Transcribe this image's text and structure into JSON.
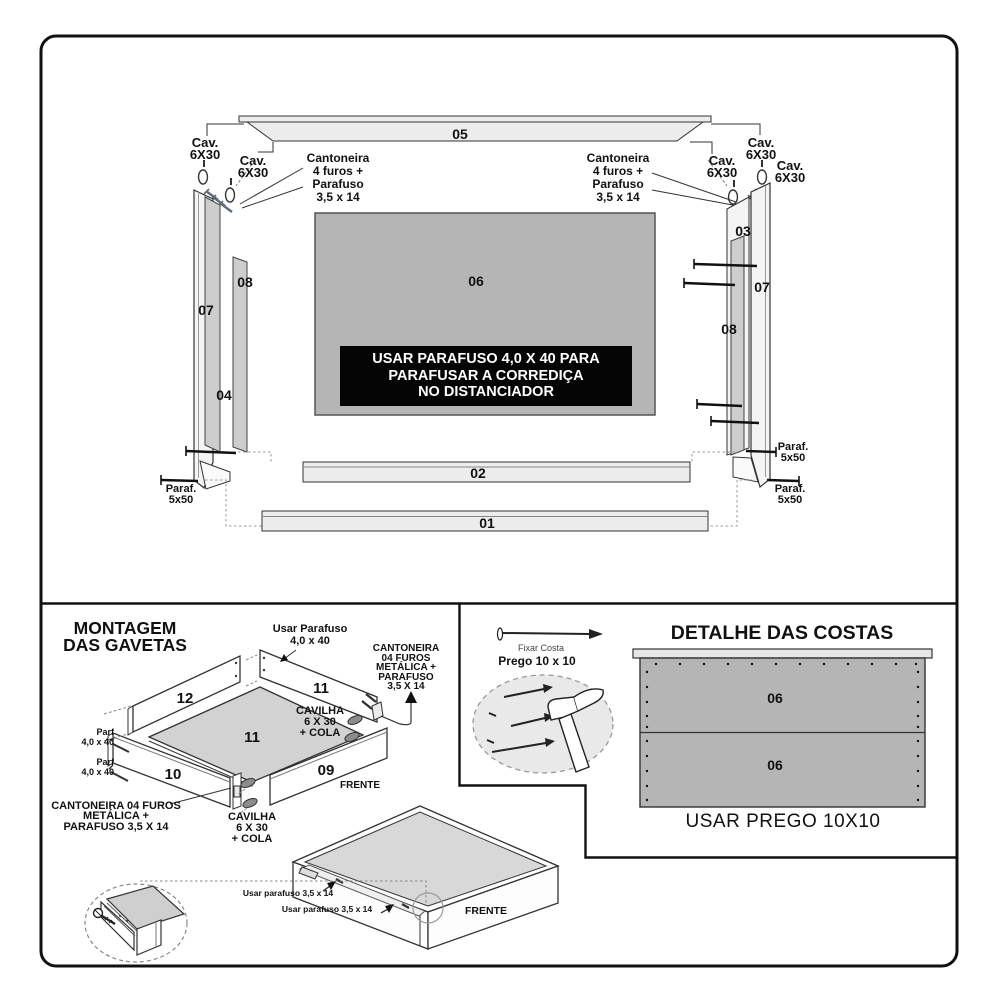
{
  "colors": {
    "line": "#222222",
    "panel_light": "#ececec",
    "panel_mid": "#b5b5b5",
    "panel_soft": "#d6d6d6",
    "note_bg": "#000000",
    "note_text": "#ffffff"
  },
  "top_diagram": {
    "panel_labels": {
      "p05": "05",
      "p06": "06",
      "p07_left": "07",
      "p07_right": "07",
      "p08_left": "08",
      "p08_right": "08",
      "p04": "04",
      "p03": "03",
      "p02": "02",
      "p01": "01"
    },
    "cav": {
      "l1": "Cav.",
      "l2": "6X30"
    },
    "cantoneira": {
      "l1": "Cantoneira",
      "l2": "4 furos +",
      "l3": "Parafuso",
      "l4": "3,5 x 14"
    },
    "paraf": {
      "l1": "Paraf.",
      "l2": "5x50"
    },
    "note": {
      "l1": "USAR PARAFUSO 4,0 X 40 PARA",
      "l2": "PARAFUSAR A CORREDIÇA",
      "l3": "NO DISTANCIADOR"
    }
  },
  "montagem": {
    "title": {
      "l1": "MONTAGEM",
      "l2": "DAS GAVETAS"
    },
    "usar_parafuso": {
      "l1": "Usar Parafuso",
      "l2": "4,0 x 40"
    },
    "cantoneira_right": {
      "l1": "CANTONEIRA",
      "l2": "04 FUROS",
      "l3": "METÁLICA +",
      "l4": "PARAFUSO",
      "l5": "3,5 X 14"
    },
    "cantoneira_bottom": {
      "l1": "CANTONEIRA 04 FUROS",
      "l2": "METÁLICA +",
      "l3": "PARAFUSO 3,5 X 14"
    },
    "cavilha": {
      "l1": "CAVILHA",
      "l2": "6 X 30",
      "l3": "+ COLA"
    },
    "parf": {
      "l1": "Parf",
      "l2": "4,0 x 40"
    },
    "panel_labels": {
      "p12": "12",
      "p11_back": "11",
      "p11_bottom": "11",
      "p10": "10",
      "p09": "09"
    },
    "frente": "FRENTE"
  },
  "fixar_costa": {
    "caption_small": "Fixar Costa",
    "caption_bold": "Prego 10 x 10"
  },
  "detalhe_costas": {
    "title": "DETALHE DAS COSTAS",
    "panel_top": "06",
    "panel_bottom": "06",
    "note": "USAR PREGO 10X10"
  },
  "drawer_assembled": {
    "screw_note": "Usar parafuso 3,5 x 14",
    "frente": "FRENTE"
  }
}
